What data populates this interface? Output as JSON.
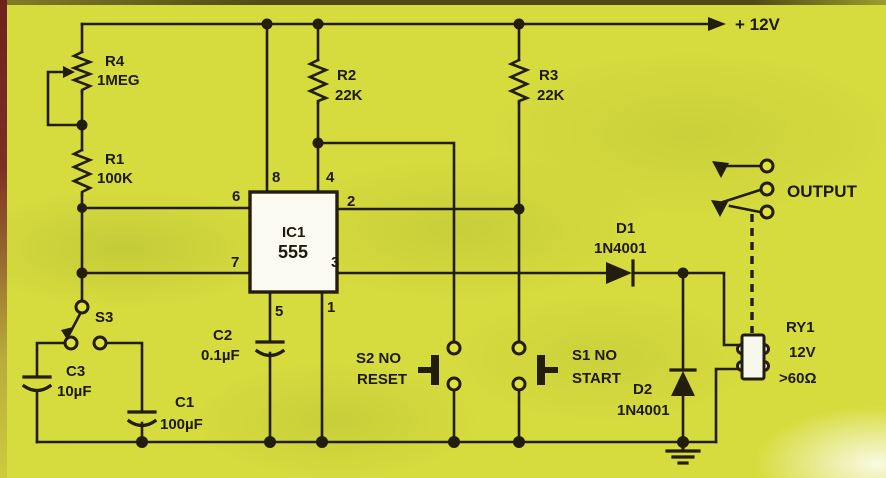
{
  "schematic": {
    "power_label": "+ 12V",
    "output_label": "OUTPUT",
    "components": {
      "r4": {
        "ref": "R4",
        "value": "1MEG"
      },
      "r1": {
        "ref": "R1",
        "value": "100K"
      },
      "r2": {
        "ref": "R2",
        "value": "22K"
      },
      "r3": {
        "ref": "R3",
        "value": "22K"
      },
      "c1": {
        "ref": "C1",
        "value": "100µF"
      },
      "c2": {
        "ref": "C2",
        "value": "0.1µF"
      },
      "c3": {
        "ref": "C3",
        "value": "10µF"
      },
      "s1": {
        "ref": "S1 NO",
        "value": "START"
      },
      "s2": {
        "ref": "S2 NO",
        "value": "RESET"
      },
      "s3": {
        "ref": "S3"
      },
      "d1": {
        "ref": "D1",
        "value": "1N4001"
      },
      "d2": {
        "ref": "D2",
        "value": "1N4001"
      },
      "ic1": {
        "ref": "IC1",
        "value": "555"
      },
      "ry1": {
        "ref": "RY1",
        "voltage": "12V",
        "resistance": ">60Ω"
      }
    },
    "ic_pins": {
      "p1": "1",
      "p2": "2",
      "p3": "3",
      "p4": "4",
      "p5": "5",
      "p6": "6",
      "p7": "7",
      "p8": "8"
    },
    "colors": {
      "background": "#d7dc3e",
      "line": "#231d0e",
      "ic_fill": "#fbfaf0",
      "left_border": "#7c2f26"
    }
  }
}
